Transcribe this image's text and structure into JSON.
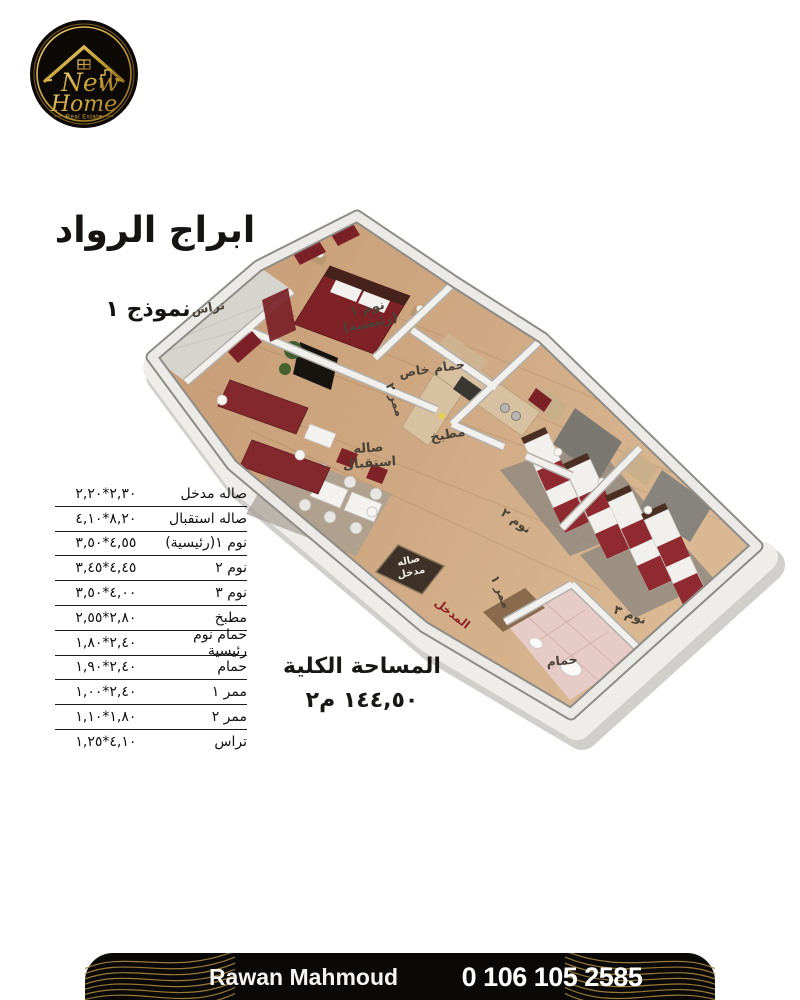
{
  "logo": {
    "word_top": "New",
    "word_bottom": "Home",
    "tagline": "Real Estate"
  },
  "header": {
    "title": "ابراج الرواد",
    "model": "نموذج ١"
  },
  "plan": {
    "labels": [
      {
        "id": "terrace",
        "text": "تراس"
      },
      {
        "id": "bedroom1",
        "text": "نوم ١\n(رئيسية)"
      },
      {
        "id": "private-bath",
        "text": "حمام خاص"
      },
      {
        "id": "corridor2",
        "text": "ممر ٢"
      },
      {
        "id": "kitchen",
        "text": "مطبخ"
      },
      {
        "id": "reception",
        "text": "صاله\nاستقبال"
      },
      {
        "id": "entrance-hall",
        "text": "صاله\nمدخل"
      },
      {
        "id": "entrance",
        "text": "المدخل"
      },
      {
        "id": "corridor1",
        "text": "ممر ١"
      },
      {
        "id": "bedroom2",
        "text": "نوم ٢"
      },
      {
        "id": "bedroom3",
        "text": "نوم ٣"
      },
      {
        "id": "bathroom",
        "text": "حمام"
      }
    ]
  },
  "table": {
    "rows": [
      {
        "name": "صاله مدخل",
        "dims": "٢,٣٠*٢,٢٠"
      },
      {
        "name": "صاله استقبال",
        "dims": "٨,٢٠*٤,١٠"
      },
      {
        "name": "نوم ١(رئيسية)",
        "dims": "٤,٥٥*٣,٥٠"
      },
      {
        "name": "نوم ٢",
        "dims": "٤,٤٥*٣,٤٥"
      },
      {
        "name": "نوم ٣",
        "dims": "٤,٠٠*٣,٥٠"
      },
      {
        "name": "مطبخ",
        "dims": "٢,٨٠*٢,٥٥"
      },
      {
        "name": "حمام نوم رئيسية",
        "dims": "٢,٤٠*١,٨٠"
      },
      {
        "name": "حمام",
        "dims": "٢,٤٠*١,٩٠"
      },
      {
        "name": "ممر ١",
        "dims": "٢,٤٠*١,٠٠"
      },
      {
        "name": "ممر ٢",
        "dims": "١,٨٠*١,١٠"
      },
      {
        "name": "تراس",
        "dims": "٤,١٠*١,٢٥"
      }
    ]
  },
  "total_area": {
    "label": "المساحة الكلية",
    "value": "١٤٤,٥٠ م٢"
  },
  "footer": {
    "agent": "Rawan Mahmoud",
    "phone": "0 106 105 2585"
  },
  "colors": {
    "gold": "#C9A437",
    "maroon": "#7E2228",
    "bar_black": "#0B0907"
  }
}
